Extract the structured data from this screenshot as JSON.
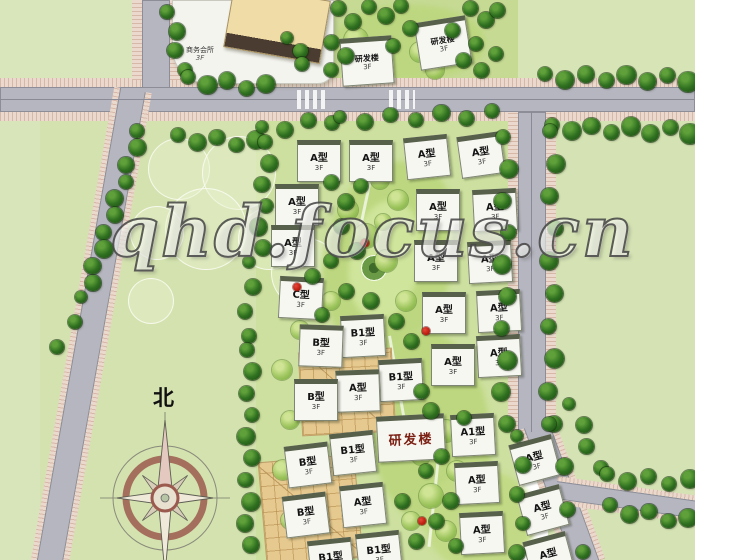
{
  "watermark": {
    "text": "qhd.focus.cn"
  },
  "compass": {
    "north_label": "北"
  },
  "club_building": {
    "label": "商务会所",
    "floors": "3F"
  },
  "house_floors": "3F",
  "colors": {
    "lawn_light": "#d8e5ba",
    "lawn_block": "#cde09f",
    "park_swath": "#bcd77f",
    "road": "#b6b6c0",
    "sidewalk": "#ead9cc",
    "tree_dark": "#2f7020",
    "tree_light": "#9cc45c",
    "house_roof": "#f7f7f2",
    "roof_shadow": "#57604b",
    "court_paving": "#e6c98f",
    "rnd_text": "#7c2014",
    "red_accent": "#b51708",
    "compass_ring": "#9b5a4e",
    "watermark_outline": "#484848"
  },
  "houses": [
    {
      "x": 318,
      "y": 158,
      "label": "A型",
      "rot": 0,
      "type": "h"
    },
    {
      "x": 370,
      "y": 158,
      "label": "A型",
      "rot": 0,
      "type": "h"
    },
    {
      "x": 426,
      "y": 154,
      "label": "A型",
      "rot": -6,
      "type": "h"
    },
    {
      "x": 480,
      "y": 152,
      "label": "A型",
      "rot": -8,
      "type": "h"
    },
    {
      "x": 296,
      "y": 202,
      "label": "A型",
      "rot": 0,
      "type": "h"
    },
    {
      "x": 437,
      "y": 207,
      "label": "A型",
      "rot": 0,
      "type": "h"
    },
    {
      "x": 494,
      "y": 207,
      "label": "A型",
      "rot": -3,
      "type": "h"
    },
    {
      "x": 292,
      "y": 243,
      "label": "A型",
      "rot": 0,
      "type": "h"
    },
    {
      "x": 435,
      "y": 258,
      "label": "A型",
      "rot": 0,
      "type": "h"
    },
    {
      "x": 489,
      "y": 259,
      "label": "A型",
      "rot": -3,
      "type": "h"
    },
    {
      "x": 300,
      "y": 295,
      "label": "C型",
      "rot": 3,
      "type": "h"
    },
    {
      "x": 443,
      "y": 310,
      "label": "A型",
      "rot": 0,
      "type": "h"
    },
    {
      "x": 498,
      "y": 308,
      "label": "A型",
      "rot": -3,
      "type": "h"
    },
    {
      "x": 362,
      "y": 333,
      "label": "B1型",
      "rot": -3,
      "type": "h"
    },
    {
      "x": 320,
      "y": 343,
      "label": "B型",
      "rot": 2,
      "type": "h"
    },
    {
      "x": 498,
      "y": 353,
      "label": "A型",
      "rot": -3,
      "type": "h"
    },
    {
      "x": 452,
      "y": 362,
      "label": "A型",
      "rot": 0,
      "type": "h"
    },
    {
      "x": 400,
      "y": 377,
      "label": "B1型",
      "rot": -3,
      "type": "h"
    },
    {
      "x": 357,
      "y": 388,
      "label": "A型",
      "rot": -2,
      "type": "h"
    },
    {
      "x": 315,
      "y": 397,
      "label": "B型",
      "rot": 0,
      "type": "h"
    },
    {
      "x": 410,
      "y": 435,
      "label": "研发楼",
      "rot": -3,
      "type": "r"
    },
    {
      "x": 472,
      "y": 432,
      "label": "A1型",
      "rot": -3,
      "type": "h"
    },
    {
      "x": 352,
      "y": 450,
      "label": "B1型",
      "rot": -6,
      "type": "h"
    },
    {
      "x": 307,
      "y": 462,
      "label": "B型",
      "rot": -7,
      "type": "h"
    },
    {
      "x": 476,
      "y": 480,
      "label": "A型",
      "rot": -3,
      "type": "h"
    },
    {
      "x": 362,
      "y": 502,
      "label": "A型",
      "rot": -6,
      "type": "h"
    },
    {
      "x": 305,
      "y": 512,
      "label": "B型",
      "rot": -7,
      "type": "h"
    },
    {
      "x": 481,
      "y": 530,
      "label": "A型",
      "rot": -3,
      "type": "h"
    },
    {
      "x": 378,
      "y": 550,
      "label": "B1型",
      "rot": -6,
      "type": "h"
    },
    {
      "x": 330,
      "y": 557,
      "label": "B1型",
      "rot": -6,
      "type": "h"
    },
    {
      "x": 534,
      "y": 457,
      "label": "A型",
      "rot": -15,
      "type": "h"
    },
    {
      "x": 542,
      "y": 507,
      "label": "A型",
      "rot": -15,
      "type": "h"
    },
    {
      "x": 548,
      "y": 554,
      "label": "A型",
      "rot": -15,
      "type": "h"
    },
    {
      "x": 366,
      "y": 58,
      "label": "研发楼",
      "rot": -4,
      "type": "t"
    },
    {
      "x": 442,
      "y": 40,
      "label": "研发楼",
      "rot": -9,
      "type": "t"
    }
  ],
  "tree_rows": [
    [
      170,
      12,
      182,
      70,
      4,
      16
    ],
    [
      188,
      80,
      266,
      87,
      5,
      17
    ],
    [
      290,
      38,
      305,
      64,
      3,
      14
    ],
    [
      545,
      77,
      688,
      79,
      8,
      17
    ],
    [
      552,
      128,
      690,
      131,
      8,
      17
    ],
    [
      178,
      138,
      256,
      143,
      5,
      16
    ],
    [
      262,
      130,
      332,
      120,
      4,
      15
    ],
    [
      140,
      131,
      90,
      283,
      10,
      16
    ],
    [
      84,
      297,
      60,
      347,
      3,
      14
    ],
    [
      268,
      142,
      260,
      248,
      6,
      16
    ],
    [
      252,
      262,
      246,
      336,
      4,
      15
    ],
    [
      250,
      350,
      248,
      545,
      10,
      16
    ],
    [
      506,
      137,
      504,
      424,
      10,
      17
    ],
    [
      553,
      131,
      551,
      424,
      10,
      17
    ],
    [
      552,
      424,
      580,
      552,
      4,
      16
    ],
    [
      572,
      404,
      598,
      468,
      4,
      15
    ],
    [
      607,
      477,
      690,
      482,
      5,
      16
    ],
    [
      610,
      508,
      688,
      521,
      5,
      16
    ],
    [
      520,
      436,
      520,
      553,
      5,
      15
    ],
    [
      340,
      120,
      492,
      114,
      7,
      15
    ]
  ],
  "trees_dark": [
    [
      338,
      8,
      15
    ],
    [
      353,
      22,
      16
    ],
    [
      369,
      7,
      14
    ],
    [
      386,
      16,
      16
    ],
    [
      401,
      6,
      14
    ],
    [
      410,
      28,
      15
    ],
    [
      331,
      42,
      15
    ],
    [
      346,
      56,
      16
    ],
    [
      331,
      70,
      14
    ],
    [
      393,
      46,
      14
    ],
    [
      452,
      30,
      15
    ],
    [
      470,
      8,
      15
    ],
    [
      486,
      20,
      16
    ],
    [
      476,
      44,
      14
    ],
    [
      463,
      60,
      15
    ],
    [
      481,
      70,
      15
    ],
    [
      496,
      54,
      14
    ],
    [
      497,
      10,
      15
    ],
    [
      331,
      182,
      15
    ],
    [
      346,
      202,
      16
    ],
    [
      361,
      186,
      14
    ],
    [
      341,
      226,
      15
    ],
    [
      357,
      251,
      16
    ],
    [
      331,
      261,
      14
    ],
    [
      312,
      276,
      15
    ],
    [
      346,
      291,
      15
    ],
    [
      371,
      301,
      16
    ],
    [
      396,
      321,
      15
    ],
    [
      411,
      341,
      15
    ],
    [
      322,
      315,
      14
    ],
    [
      421,
      391,
      15
    ],
    [
      431,
      411,
      16
    ],
    [
      441,
      456,
      15
    ],
    [
      426,
      471,
      14
    ],
    [
      451,
      501,
      16
    ],
    [
      436,
      521,
      15
    ],
    [
      416,
      541,
      15
    ],
    [
      456,
      546,
      14
    ],
    [
      402,
      501,
      15
    ],
    [
      464,
      418,
      14
    ]
  ],
  "trees_light": [
    [
      356,
      40,
      24
    ],
    [
      420,
      52,
      20
    ],
    [
      435,
      70,
      18
    ],
    [
      352,
      72,
      16
    ],
    [
      348,
      210,
      20
    ],
    [
      366,
      236,
      24
    ],
    [
      386,
      261,
      22
    ],
    [
      331,
      301,
      18
    ],
    [
      406,
      301,
      20
    ],
    [
      446,
      431,
      22
    ],
    [
      421,
      456,
      18
    ],
    [
      457,
      471,
      20
    ],
    [
      431,
      496,
      24
    ],
    [
      411,
      521,
      18
    ],
    [
      446,
      531,
      20
    ],
    [
      380,
      180,
      18
    ],
    [
      398,
      200,
      20
    ],
    [
      383,
      222,
      16
    ],
    [
      300,
      330,
      18
    ],
    [
      282,
      370,
      20
    ],
    [
      290,
      420,
      18
    ],
    [
      283,
      470,
      20
    ],
    [
      290,
      520,
      18
    ]
  ],
  "landscape_circles": [
    [
      178,
      168,
      30
    ],
    [
      238,
      172,
      36
    ],
    [
      205,
      228,
      40
    ],
    [
      156,
      232,
      26
    ],
    [
      268,
      238,
      30
    ],
    [
      305,
      272,
      34
    ],
    [
      150,
      300,
      22
    ]
  ],
  "red_accents": [
    [
      365,
      243
    ],
    [
      426,
      331
    ],
    [
      422,
      521
    ],
    [
      297,
      287
    ]
  ]
}
